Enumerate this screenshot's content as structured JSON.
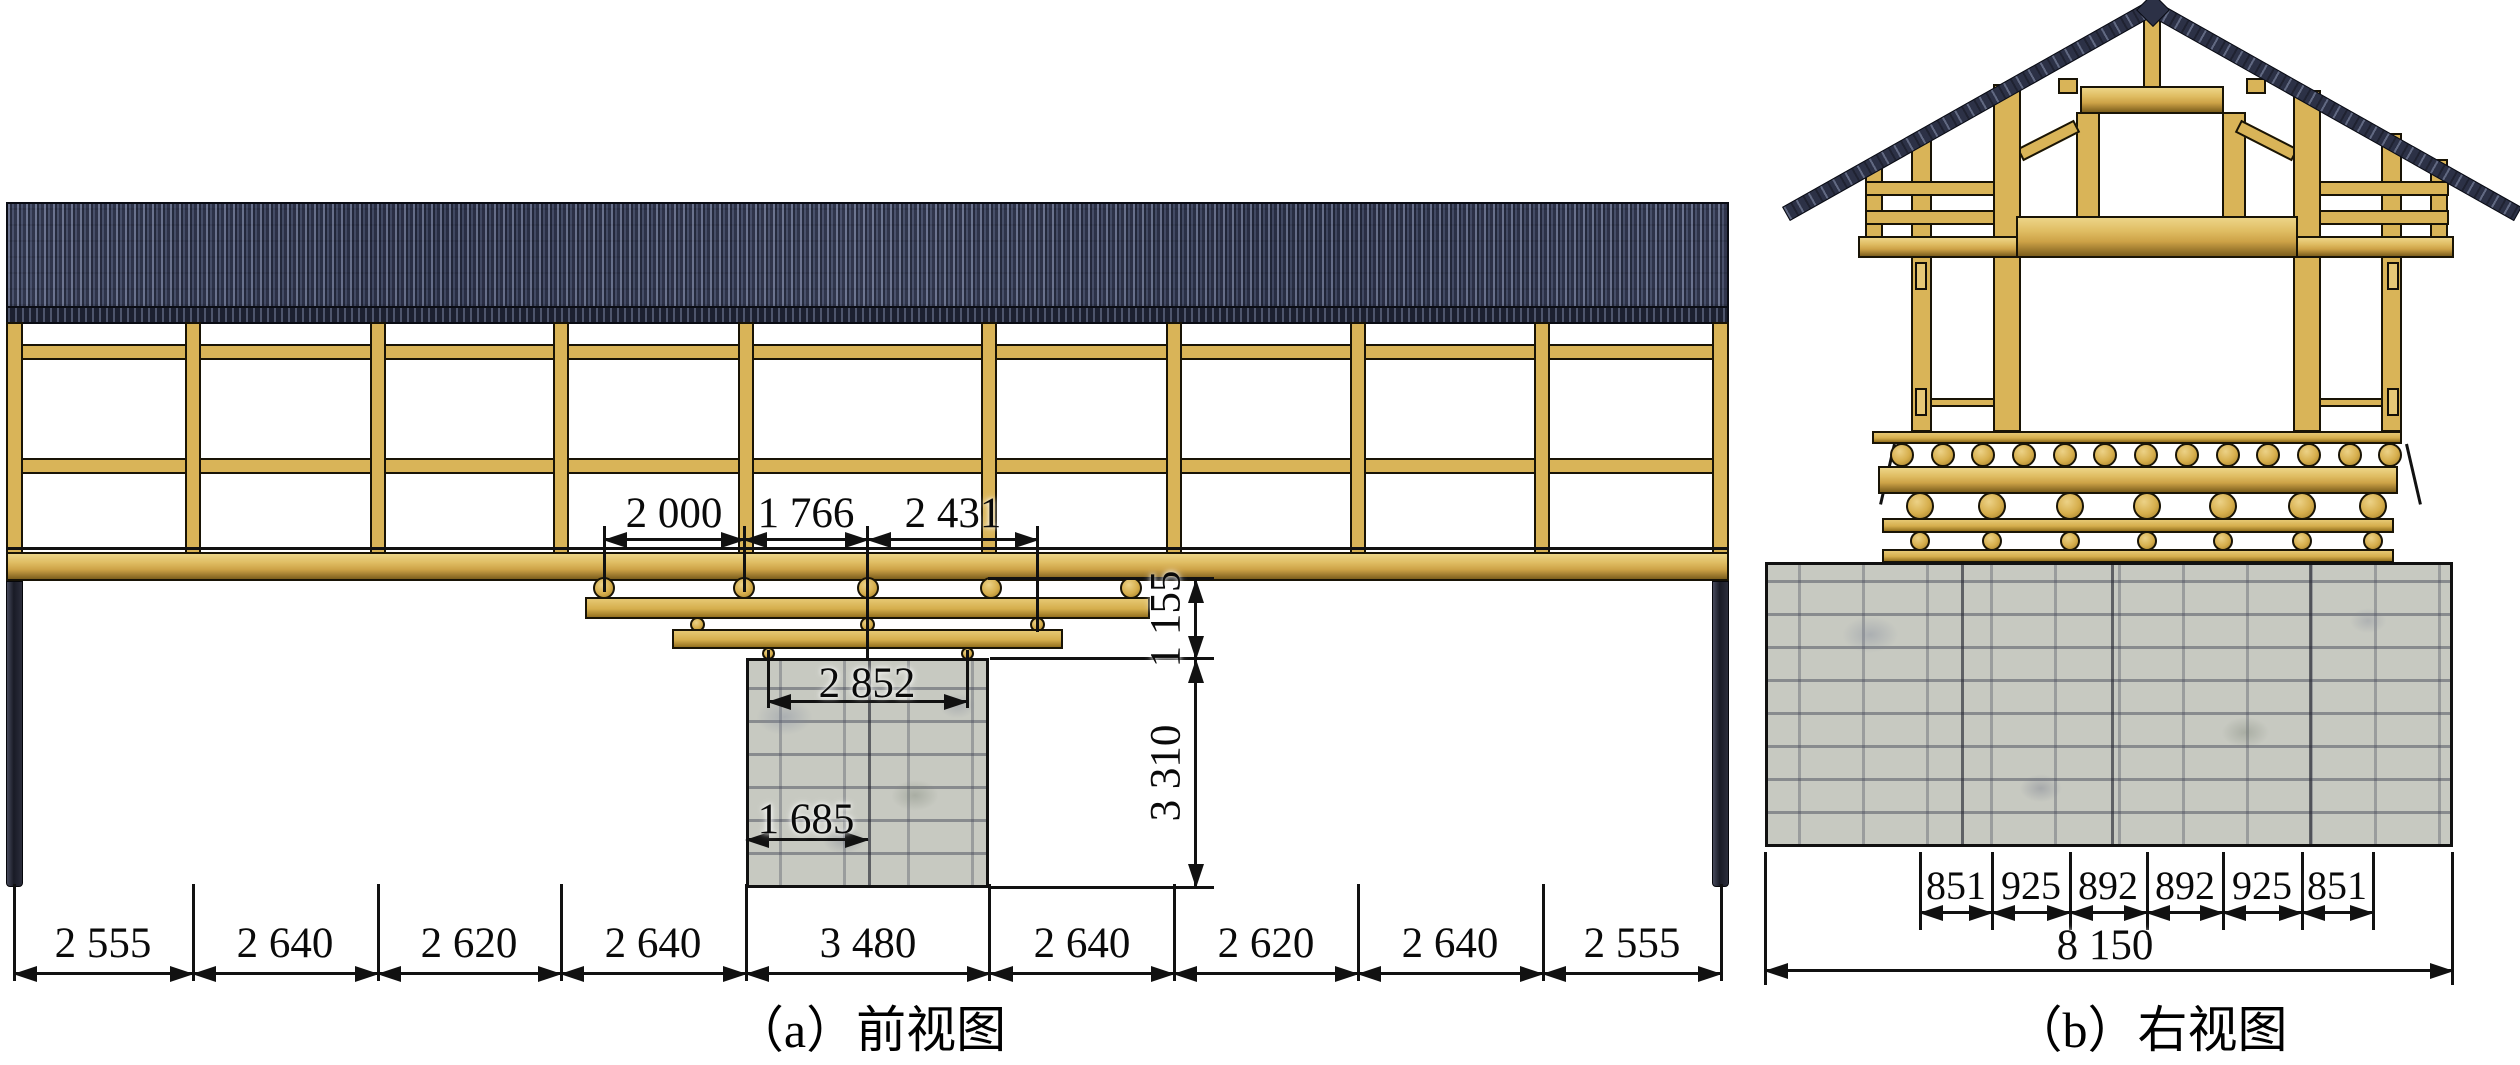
{
  "figure": {
    "type": "engineering-drawing",
    "subject": "covered timber bridge elevation drawings",
    "background": "#ffffff"
  },
  "front_view": {
    "caption": "（a）前视图",
    "bottom_dims": [
      "2 555",
      "2 640",
      "2 620",
      "2 640",
      "3 480",
      "2 640",
      "2 620",
      "2 640",
      "2 555"
    ],
    "span_dims": [
      "2 000",
      "1 766",
      "2 431"
    ],
    "pier_top_width": "2 852",
    "pier_half_width": "1 685",
    "deck_to_pier_height": "1 155",
    "pier_height": "3 310"
  },
  "right_view": {
    "caption": "（b）右视图",
    "log_spacing_dims": [
      "851",
      "925",
      "892",
      "892",
      "925",
      "851"
    ],
    "abutment_width": "8 150"
  },
  "colors": {
    "wood": "#d9b458",
    "wood_shadow": "#7c5e1d",
    "roof_tile": "#39405a",
    "roof_fringe": "#1c2030",
    "stone": "#c7c9c1",
    "dark_post": "#191b26",
    "line": "#111111"
  }
}
